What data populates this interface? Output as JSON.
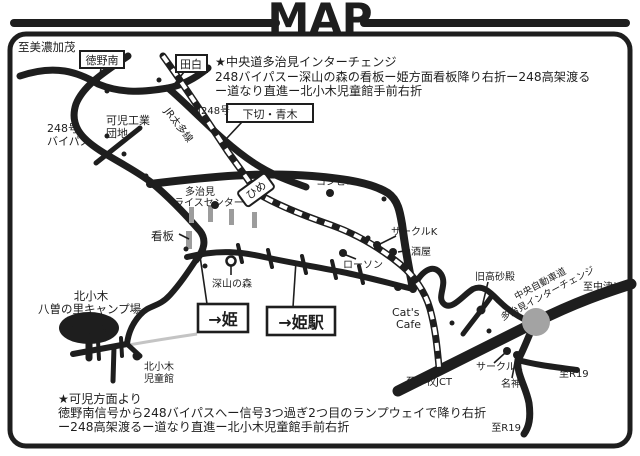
{
  "title": "MAP",
  "colors": {
    "ink": "#1e1e1e",
    "signboard_gray": "#9c9c9c",
    "river_gray": "#c4c4c4",
    "interchange_gray": "#a3a3a3"
  },
  "notes": {
    "top": [
      "★中央道多治見インターチェンジ",
      "248バイパスー深山の森の看板ー姫方面看板降り右折ー248高架渡る",
      "ー道なり直進ー北小木児童館手前右折"
    ],
    "bottom": [
      "★可児方面より",
      "徳野南信号から248バイパスへー信号3つ過ぎ2つ目のランプウェイで降り右折",
      "ー248高架渡るー道なり直進ー北小木児童館手前右折"
    ]
  },
  "boxed_labels": {
    "tokuno_minami": "徳野南",
    "tashiro": "田白",
    "shimogiri_aoki": "下切・青木",
    "hime_sign": "ひめ",
    "to_hime": "→姫",
    "to_hime_station": "→姫駅"
  },
  "labels": {
    "to_minokamo": "至美濃加茂",
    "route248_bypass": [
      "248号",
      "バイパス"
    ],
    "kani_kogyo_danchi": [
      "可児工業",
      "団地"
    ],
    "jr_taita_line": "JR太多線",
    "kyu_248": "旧248号",
    "tajimi_rice_center": [
      "多治見",
      "ライスセンター"
    ],
    "kanban": "看板",
    "konbini": "コンビニ",
    "circle_k_north": "サークルK",
    "sakaya": "酒屋",
    "lawson": "ローソン",
    "cats_cafe": [
      "Cat's",
      "Cafe"
    ],
    "miyama_no_mori": "深山の森",
    "kyu_takasagoden": "旧高砂殿",
    "chuo_expressway": [
      "中央自動車道",
      "多治見インターチェンジ"
    ],
    "to_nakatsugawa": "至中津川",
    "to_komaki_jct": "至小牧JCT",
    "circle_k_south": "サークルK",
    "meishin": "名神",
    "to_r19_east": "至R19",
    "to_r19_south": "至R19",
    "campground": [
      "北小木",
      "八曽の里キャンプ場"
    ],
    "kita_ogi_jidokan": [
      "北小木",
      "児童館"
    ],
    "koko_marker": "ココ!"
  }
}
